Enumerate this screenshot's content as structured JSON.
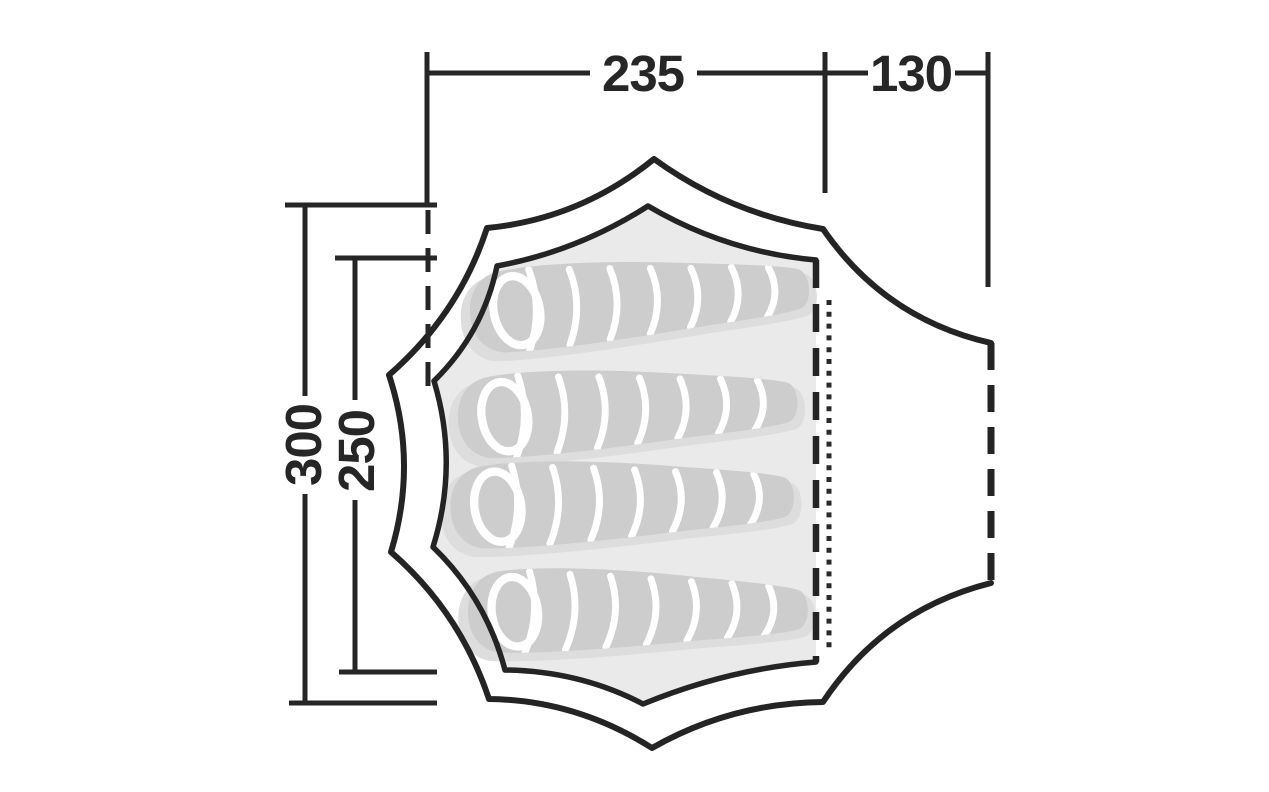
{
  "diagram": {
    "kind": "tent-floorplan-top-view",
    "dimensions": {
      "inner_width": {
        "value": "235"
      },
      "porch_depth": {
        "value": "130"
      },
      "outer_length": {
        "value": "300"
      },
      "inner_length": {
        "value": "250"
      }
    },
    "sleeping_bags": {
      "count": 4
    },
    "markers": {
      "inner_door_edge": "dashed-line",
      "zipper": "dotted-line",
      "porch_door": "dashed-line",
      "measure_reference": "dashed-extension-line"
    },
    "colors": {
      "background": "#ffffff",
      "line": "#242424",
      "text": "#262626",
      "floor": "#e9eae9",
      "bag": "#cccdcc",
      "bag_shadow": "#dcdddc",
      "stripe": "#ffffff"
    }
  }
}
